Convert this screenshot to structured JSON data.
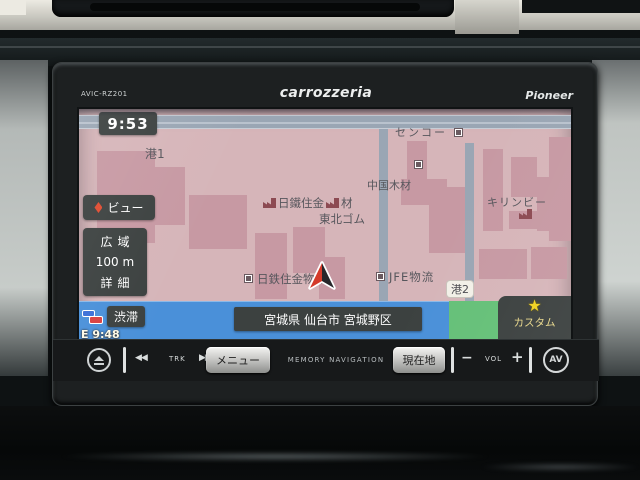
{
  "unit": {
    "model": "AVIC-RZ201",
    "brand": "carrozzeria",
    "maker": "Pioneer"
  },
  "screen": {
    "clock": "9:53",
    "view_button": "ビュー",
    "scale": {
      "wide": "広域",
      "level": "100 m",
      "detail": "詳細"
    },
    "traffic": "渋滞",
    "eta": "E 9:48",
    "address": "宮城県 仙台市 宮城野区",
    "custom": {
      "star": "★",
      "label": "カスタム"
    },
    "map_labels": {
      "port1": "港1",
      "senko": "センコー",
      "chugoku_lumber": "中国木材",
      "nittetsu_kenzai_a": "日鐵住金",
      "nittetsu_kenzai_b": "材",
      "tohoku_gomu": "東北ゴム",
      "kirin_beer": "キリンビー",
      "nittetsu_logistics": "日鉄住金物流",
      "jfe_logistics": "JFE物流",
      "port2": "港2"
    }
  },
  "controls": {
    "prev": "◀◀",
    "trk": "TRK",
    "next": "▶▶",
    "menu": "メニュー",
    "memory_nav": "MEMORY NAVIGATION",
    "current_loc": "現在地",
    "vol_minus": "−",
    "vol": "VOL",
    "vol_plus": "+",
    "av": "AV"
  },
  "icons": {
    "eject": "eject-icon",
    "view_diamond": "diamond-icon",
    "traffic_cars": "traffic-cars-icon",
    "factory": "factory-icon",
    "company_marker": "company-marker-icon",
    "nav_cursor": "navigation-cursor-icon",
    "star": "star-icon"
  },
  "colors": {
    "map_land": "#d6b5b9",
    "map_building": "#c799a3",
    "map_road": "#9aa6b4",
    "map_water": "#4a90d9",
    "map_green": "#65c078",
    "overlay_panel": "#3c4140",
    "star_yellow": "#f2d21f",
    "cursor_red": "#d43a2a"
  }
}
